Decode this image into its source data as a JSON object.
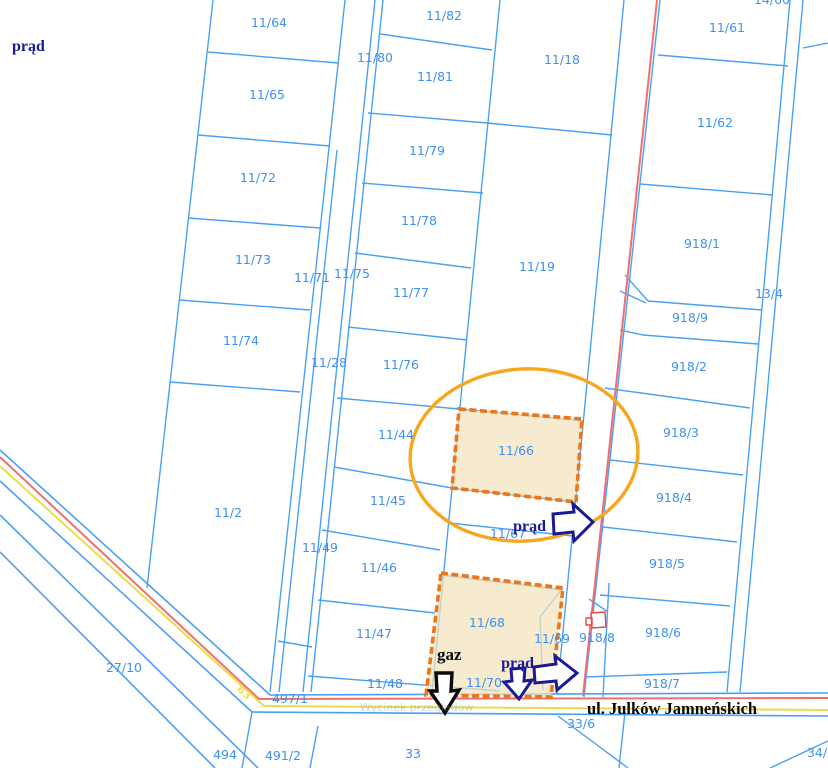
{
  "map": {
    "street_label": "ul. Julków Jamneńskich",
    "watermark": "Wycinek przeglądow",
    "highlighted_parcels": [
      "11/66",
      "11/68"
    ],
    "colors": {
      "parcel_line": "#4aa0f5",
      "label": "#4090f0",
      "highlight_fill": "#f2e3bb",
      "highlight_border": "#ee7617",
      "ellipse": "#f6a71f",
      "power_line": "#f06f6f",
      "gas_line": "#e6df4a",
      "power_text": "#1a1a96",
      "building": "#e84545"
    },
    "parcels": [
      {
        "id": "11/64",
        "x": 269,
        "y": 27
      },
      {
        "id": "14/60",
        "x": 772,
        "y": 4
      },
      {
        "id": "11/82",
        "x": 444,
        "y": 20
      },
      {
        "id": "11/18",
        "x": 562,
        "y": 64
      },
      {
        "id": "11/61",
        "x": 727,
        "y": 32
      },
      {
        "id": "11/80",
        "x": 375,
        "y": 62
      },
      {
        "id": "11/81",
        "x": 435,
        "y": 81
      },
      {
        "id": "11/65",
        "x": 267,
        "y": 99
      },
      {
        "id": "11/62",
        "x": 715,
        "y": 127
      },
      {
        "id": "11/79",
        "x": 427,
        "y": 155
      },
      {
        "id": "11/72",
        "x": 258,
        "y": 182
      },
      {
        "id": "11/78",
        "x": 419,
        "y": 225
      },
      {
        "id": "918/1",
        "x": 702,
        "y": 248
      },
      {
        "id": "11/73",
        "x": 253,
        "y": 264
      },
      {
        "id": "11/71",
        "x": 312,
        "y": 282
      },
      {
        "id": "11/75",
        "x": 352,
        "y": 278
      },
      {
        "id": "11/19",
        "x": 537,
        "y": 271
      },
      {
        "id": "11/77",
        "x": 411,
        "y": 297
      },
      {
        "id": "13/4",
        "x": 769,
        "y": 298
      },
      {
        "id": "918/9",
        "x": 690,
        "y": 322
      },
      {
        "id": "11/74",
        "x": 241,
        "y": 345
      },
      {
        "id": "11/28",
        "x": 329,
        "y": 367
      },
      {
        "id": "11/76",
        "x": 401,
        "y": 369
      },
      {
        "id": "918/2",
        "x": 689,
        "y": 371
      },
      {
        "id": "11/44",
        "x": 396,
        "y": 439
      },
      {
        "id": "918/3",
        "x": 681,
        "y": 437
      },
      {
        "id": "11/66",
        "x": 516,
        "y": 455,
        "highlighted": true
      },
      {
        "id": "11/45",
        "x": 388,
        "y": 505
      },
      {
        "id": "918/4",
        "x": 674,
        "y": 502
      },
      {
        "id": "11/2",
        "x": 228,
        "y": 517
      },
      {
        "id": "11/67",
        "x": 508,
        "y": 538
      },
      {
        "id": "11/49",
        "x": 320,
        "y": 552
      },
      {
        "id": "11/46",
        "x": 379,
        "y": 572
      },
      {
        "id": "918/5",
        "x": 667,
        "y": 568
      },
      {
        "id": "11/68",
        "x": 487,
        "y": 627,
        "highlighted": true
      },
      {
        "id": "11/47",
        "x": 374,
        "y": 638
      },
      {
        "id": "11/69",
        "x": 552,
        "y": 643
      },
      {
        "id": "918/8",
        "x": 597,
        "y": 642
      },
      {
        "id": "918/6",
        "x": 663,
        "y": 637
      },
      {
        "id": "27/10",
        "x": 124,
        "y": 672
      },
      {
        "id": "11/48",
        "x": 385,
        "y": 688
      },
      {
        "id": "11/70",
        "x": 484,
        "y": 687
      },
      {
        "id": "918/7",
        "x": 662,
        "y": 688
      },
      {
        "id": "497/1",
        "x": 290,
        "y": 703
      },
      {
        "id": "33/6",
        "x": 581,
        "y": 728
      },
      {
        "id": "494",
        "x": 225,
        "y": 759
      },
      {
        "id": "491/2",
        "x": 283,
        "y": 760
      },
      {
        "id": "33",
        "x": 413,
        "y": 758
      },
      {
        "id": "34/7",
        "x": 821,
        "y": 757
      }
    ],
    "utility_labels": [
      {
        "text": "prąd",
        "x": 12,
        "y": 51,
        "type": "power",
        "anchor": "start"
      },
      {
        "text": "prąd",
        "x": 546,
        "y": 531,
        "type": "power",
        "anchor": "end"
      },
      {
        "text": "prąd",
        "x": 534,
        "y": 668,
        "type": "power",
        "anchor": "end"
      },
      {
        "text": "gaz",
        "x": 437,
        "y": 660,
        "type": "gas",
        "anchor": "start"
      },
      {
        "text": "63",
        "x": 236,
        "y": 690,
        "type": "gasmark",
        "anchor": "start",
        "rotate": 42
      }
    ]
  }
}
